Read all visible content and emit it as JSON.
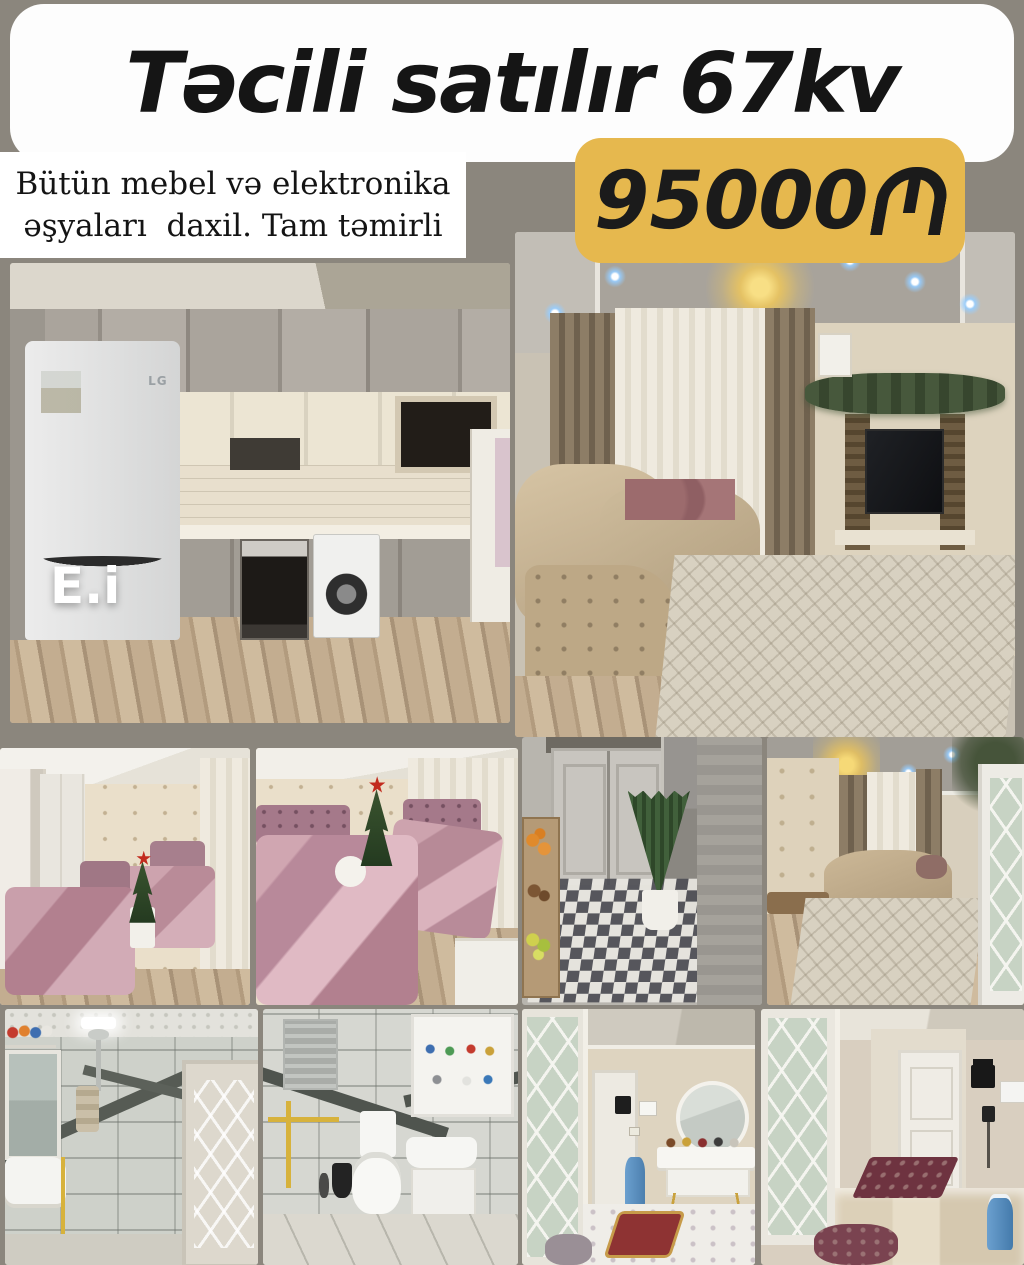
{
  "ad": {
    "title": "Təcili satılır 67kv",
    "description": "Bütün mebel və elektronika əşyaları daxil. Tam təmirli",
    "description_line1": "Bütün mebel və elektronika",
    "description_line2": "əşyaları  daxil. Tam təmirli",
    "price": "95000₼",
    "price_value": "95000",
    "price_currency": "₼ (Azerbaijani manat)",
    "watermark": "E.i",
    "appliance_brand": "LG"
  },
  "colors": {
    "background": "#8B867D",
    "card": "#FFFFFF",
    "price_badge": "#E6B84E",
    "title_text": "#151515",
    "price_text": "#1B1B1B"
  },
  "photos": [
    {
      "id": "kitchen",
      "subject": "kitchen with gray and cream cabinets, fridge, oven, washing machine"
    },
    {
      "id": "living-room",
      "subject": "living room with corner sofa, TV wall, chandelier, garland"
    },
    {
      "id": "bedroom-a",
      "subject": "bedroom with two pink beds and christmas tree"
    },
    {
      "id": "bedroom-b",
      "subject": "bedroom close view of pink satin beds and christmas tree"
    },
    {
      "id": "hallway-plants",
      "subject": "utility hallway with checkered floor, snake plant and fruit crates"
    },
    {
      "id": "sitting-room",
      "subject": "second living room with sofa, bench, rug and chandelier"
    },
    {
      "id": "bathroom-a",
      "subject": "bathroom with shower, mirror and sink"
    },
    {
      "id": "bathroom-b",
      "subject": "bathroom with toilet, sink and mirror cabinet"
    },
    {
      "id": "entrance-hall",
      "subject": "entrance hall with console table, round mirror and red rug"
    },
    {
      "id": "corridor",
      "subject": "corridor with lattice glass door, white doors and rugs"
    }
  ]
}
